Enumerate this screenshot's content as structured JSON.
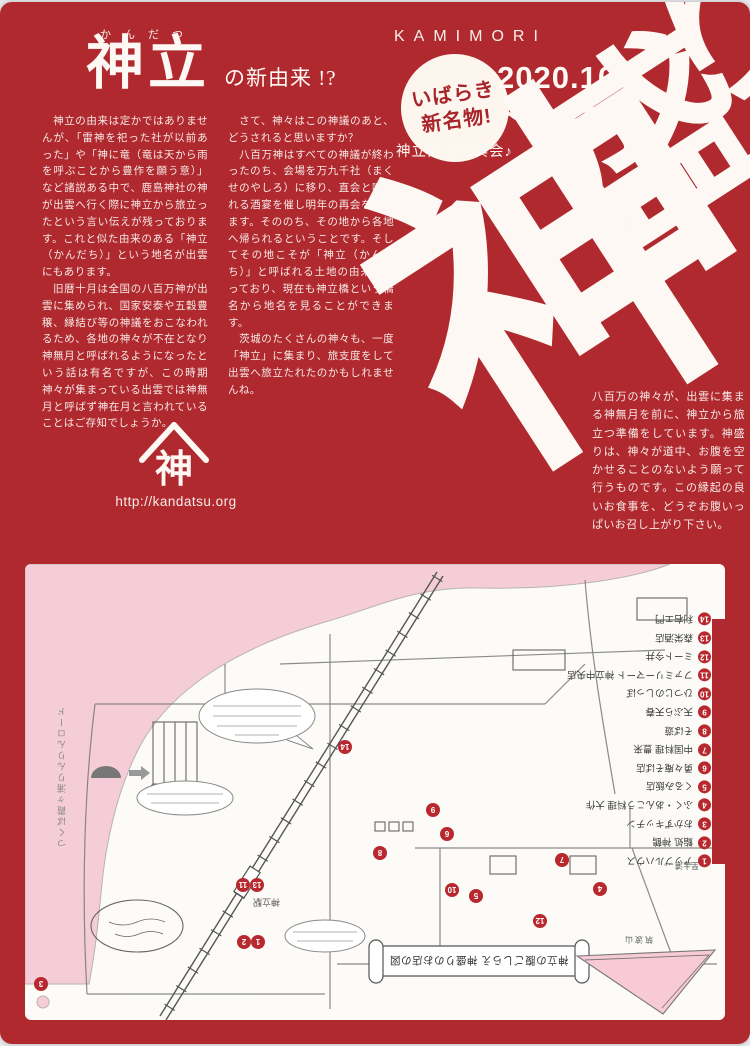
{
  "colors": {
    "red": "#b0292f",
    "pink": "#f5cdd8",
    "paper": "#fcfbf7",
    "dot_red": "#b8292f",
    "ink": "#555555"
  },
  "header": {
    "furigana": "かんだつ",
    "title": "神立",
    "title_suffix": "の新由来 !?",
    "brand": "KAMIMORI",
    "badge": {
      "line1": "いばらき",
      "line2": "新名物!"
    },
    "period": {
      "line1": "2020.10.2",
      "line2": "～ 11.30"
    },
    "organizer": "神立商工振興会♪"
  },
  "calligraphy": {
    "chars": [
      "神",
      "盛",
      "り"
    ]
  },
  "body": {
    "col1": [
      "　神立の由来は定かではありませんが、「雷神を祀った社が以前あった」や「神に竜（竜は天から雨を呼ぶことから豊作を願う意）」など諸説ある中で、鹿島神社の神が出雲へ行く際に神立から旅立ったという言い伝えが残っております。これと似た由来のある「神立（かんだち）」という地名が出雲にもあります。",
      "　旧暦十月は全国の八百万神が出雲に集められ、国家安泰や五穀豊穣、縁結び等の神議をおこなわれるため、各地の神々が不在となり神無月と呼ばれるようになったという話は有名ですが、この時期神々が集まっている出雲では神無月と呼ばず神在月と言われていることはご存知でしょうか。"
    ],
    "col2": [
      "　さて、神々はこの神議のあと、どうされると思いますか？",
      "　八百万神はすべての神議が終わったのち、会場を万九千社（まくせのやしろ）に移り、直会と呼ばれる酒宴を催し明年の再会を期します。そののち、その地から各地へ帰られるということです。そしてその地こそが「神立（かんだち）」と呼ばれる土地の由来となっており、現在も神立橋という橋名から地名を見ることができます。",
      "　茨城のたくさんの神々も、一度「神立」に集まり、旅支度をして出雲へ旅立たれたのかもしれませんね。"
    ],
    "col3": [
      "八百万の神々が、出雲に集まる神無月を前に、神立から旅立つ準備をしています。神盛りは、神々が道中、お腹を空かせることのないよう願って行うものです。この縁起の良いお食事を、どうぞお腹いっぱいお召し上がり下さい。"
    ]
  },
  "logo": {
    "char": "神",
    "url": "http://kandatsu.org"
  },
  "map": {
    "scroll_title": "神立の腹ごしらえ 神盛りのお店の図",
    "station": "神立駅",
    "to_tsuchiura": "至土浦→",
    "mountain": "筑波山",
    "cycling_road": "つくば霞ヶ浦りんりんロード",
    "legend": [
      {
        "num": 1,
        "label": "アップルハウス"
      },
      {
        "num": 2,
        "label": "鮨処 神鶴"
      },
      {
        "num": 3,
        "label": "おかずキッチン"
      },
      {
        "num": 4,
        "label": "ふく・あんこう料理 大作"
      },
      {
        "num": 5,
        "label": "くるみ飯店"
      },
      {
        "num": 6,
        "label": "勇々庵そば店"
      },
      {
        "num": 7,
        "label": "中国料理 豊来"
      },
      {
        "num": 8,
        "label": "そば遊"
      },
      {
        "num": 9,
        "label": "天ぷら天春"
      },
      {
        "num": 10,
        "label": "ひつじのしっぽ"
      },
      {
        "num": 11,
        "label": "ファミリーマート 神立中央店"
      },
      {
        "num": 12,
        "label": "ミート今井"
      },
      {
        "num": 13,
        "label": "森栄酒店"
      },
      {
        "num": 14,
        "label": "利右エ門"
      }
    ],
    "dots": [
      {
        "num": 1,
        "x": 233,
        "y": 378
      },
      {
        "num": 2,
        "x": 219,
        "y": 378
      },
      {
        "num": 3,
        "x": 16,
        "y": 420
      },
      {
        "num": 4,
        "x": 575,
        "y": 325
      },
      {
        "num": 5,
        "x": 451,
        "y": 332
      },
      {
        "num": 6,
        "x": 422,
        "y": 270
      },
      {
        "num": 7,
        "x": 537,
        "y": 296
      },
      {
        "num": 8,
        "x": 355,
        "y": 289
      },
      {
        "num": 9,
        "x": 408,
        "y": 246
      },
      {
        "num": 10,
        "x": 427,
        "y": 326
      },
      {
        "num": 11,
        "x": 218,
        "y": 321
      },
      {
        "num": 12,
        "x": 515,
        "y": 357
      },
      {
        "num": 13,
        "x": 232,
        "y": 321
      },
      {
        "num": 14,
        "x": 320,
        "y": 183
      }
    ]
  }
}
